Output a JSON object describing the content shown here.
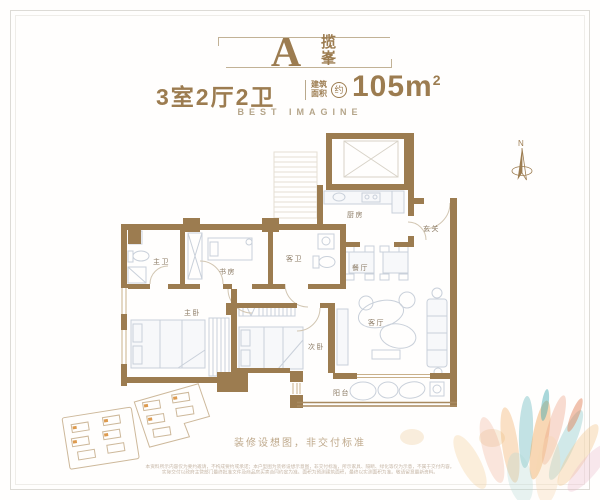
{
  "header": {
    "unit_letter": "A",
    "unit_name_char1": "揽",
    "unit_name_char2": "峯",
    "rooms_summary": "3室2厅2卫",
    "area_label_top": "建筑",
    "area_label_bottom": "面积",
    "area_circle": "约",
    "area_number": "105m",
    "area_superscript": "2",
    "tagline": "BEST IMAGINE"
  },
  "floorplan": {
    "rooms": {
      "kitchen": "厨房",
      "entry": "玄关",
      "dining": "餐厅",
      "guest_bath": "客卫",
      "study": "书房",
      "master_bath": "主卫",
      "master_bedroom": "主卧",
      "second_bedroom": "次卧",
      "living_room": "客厅",
      "balcony": "阳台"
    },
    "compass_label": "N",
    "note": "装修设想图，非交付标准"
  },
  "footer": {
    "disclaimer_line1": "本资料所示内容仅为要约邀请，不构成要约或承诺；本户型图为装修设想示意图，非交付标准，所示家具、隔断、绿化等仅为示意，不属于交付内容。",
    "disclaimer_line2": "实际交付以政府主管部门最终批准文件及商品房买卖合同约定为准。面积为预测建筑面积，最终以实测面积为准。敬请留意最新资料。"
  },
  "colors": {
    "wall": "#9c7c50",
    "window_tan": "#c9b08a",
    "furniture": "#c9d0da",
    "label": "#8b7a64"
  }
}
